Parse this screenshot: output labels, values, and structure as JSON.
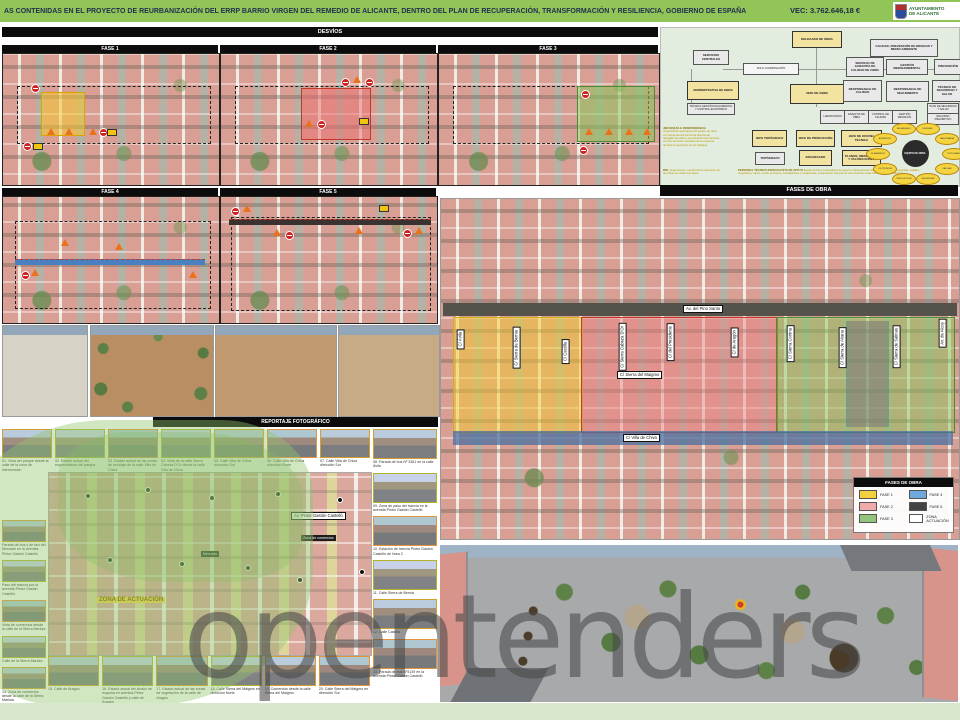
{
  "colors": {
    "header_green": "#92c558",
    "fase1": "#f4d03f",
    "fase2": "#f1a9a9",
    "fase3": "#93c47d",
    "fase4": "#6fa8dc",
    "fase5": "#434343",
    "zona": "#ffffff"
  },
  "header": {
    "title": "AS CONTENIDAS EN EL PROYECTO DE REURBANIZACIÓN DEL ERRP BARRIO VIRGEN DEL REMEDIO DE ALICANTE, DENTRO DEL PLAN DE RECUPERACIÓN, TRANSFORMACIÓN Y RESILIENCIA, GOBIERNO DE ESPAÑA",
    "vec": "VEC:  3.762.646,18 €",
    "logo_line1": "AYUNTAMIENTO",
    "logo_line2": "DE  ALICANTE"
  },
  "desvios": {
    "title": "DESVÍOS",
    "fase1": "FASE 1",
    "fase2": "FASE 2",
    "fase3": "FASE 3",
    "fase4": "FASE 4",
    "fase5": "FASE 5"
  },
  "fases_obra_bar": "FASES DE OBRA",
  "org": {
    "delegado": "DELEGADO DE OBRA",
    "calidad_prl": "CALIDAD, PREVENCIÓN DE RIESGOS Y MEDIO AMBIENTE",
    "servicios": "SERVICIOS CENTRALES",
    "coordinacion": "SOLO COORDINACIÓN",
    "garantia": "SERVICIO DE GARANTÍA DE CALIDAD DE OBRA",
    "medioambiental": "GESTIÓN MEDIOAMBIENTAL",
    "prevencion": "PREVENCIÓN",
    "administrativa": "ADMINISTRATIVA DE OBRA",
    "admin_sub": "TÉCNICO GESTIÓN DOCUMENTAL Y CONTROL ECONÓMICO",
    "jefe_obra": "JEFE DE OBRA",
    "resp_calidad": "RESPONSABLE DE CALIDAD",
    "resp_seguimiento": "RESPONSABLE DE SEGUIMIENTO",
    "tecnico_ss": "TÉCNICO DE SEGURIDAD Y SALUD",
    "sub1": "LABORATORIO",
    "sub2": "ENSAYOS DE OBRA",
    "sub3": "CONTROL DE CALIDAD",
    "sub4": "GESTIÓN RESIDUOS",
    "plan_ss": "PLAN DE SEGURIDAD Y SALUD",
    "recurso": "RECURSO PREVENTIVO",
    "jefe_topografo": "JEFE TOPÓGRAFO",
    "jefe_produccion": "JEFE DE PRODUCCIÓN",
    "jefe_oficina": "JEFE DE OFICINA TÉCNICA",
    "topografo": "TOPÓGRAFO",
    "encargado": "ENCARGADO",
    "planos": "PLANOS, MEDICIONES Y VALORACIONES",
    "jerarquia_heading": "JERARQUÍA E INDEPENDENCIA",
    "jerarquia_text": "Organización jerárquica del equipo de obra con dependencia funcional directa del delegado de obra y coordinación permanente con los servicios centrales de la empresa durante la ejecución de los trabajos.",
    "rol_heading": "ROL",
    "rol_text": "Seguimiento y control de la ejecución de las obras en todas sus fases.",
    "apoyo_heading": "PERSONAL TÉCNICO ESPECIALISTA DE APOYO",
    "apoyo_text": "Equipo técnico especialista de apoyo a obra para las distintas disciplinas: topografía, calidad, seguridad y salud, medio ambiente, instalaciones y maquinaria, a disposición del jefe de obra durante todas las fases de los trabajos.",
    "circle_center": "EQUIPO DE OBRA",
    "circle_items": [
      "TOPOGRAFÍA",
      "CALIDAD",
      "SEGURIDAD",
      "PRODUCCIÓN",
      "OF. TÉCNICA",
      "M. AMBIENTE",
      "ADMINISTR.",
      "ENCARGADO",
      "INSTALAC.",
      "MAQUINARIA"
    ]
  },
  "big_map": {
    "streets": [
      "Av. del Pino Santo",
      "C/ Ávila",
      "C/ Sierra de Bernia",
      "C/ Castilla",
      "C/ Sierra Cabeza D'Or",
      "C/ del Presidente",
      "C/ Sierra del Maigmo",
      "C/ de Aragón",
      "C/ Sierra Cortina",
      "C/ Sierra de Aitana",
      "C/ Sierra de Salinas",
      "C/ Villa de Chiva",
      "Av. de Alcoy"
    ],
    "legend": {
      "title": "FASES DE OBRA",
      "items": [
        {
          "label": "FASE 1",
          "color": "#f4d03f"
        },
        {
          "label": "FASE 2",
          "color": "#f1a9a9"
        },
        {
          "label": "FASE 3",
          "color": "#93c47d"
        },
        {
          "label": "FASE 4",
          "color": "#6fa8dc"
        },
        {
          "label": "FASE 5",
          "color": "#434343"
        },
        {
          "label": "ZONA  ACTUACIÓN",
          "color": "#ffffff"
        }
      ]
    }
  },
  "report": {
    "title": "REPORTAJE FOTOGRÁFICO",
    "top_row": [
      "01. Vista del parque desde la calle de la zona de intervención",
      "02. Estado actual del esparcimiento del parque",
      "03. Estado actual de las zonas de reciclaje de la calle Villa de Chiva",
      "04. Vista de la calle Sierra Cabeza D'Or desde la calle Villa de Chiva",
      "05. Calle Villa de Chiva dirección Sur",
      "06. Calle Villa de Chiva dirección Norte",
      "07. Calle Villa de Chiva dirección Sur"
    ],
    "right_col": [
      "08. Parada de bus Nº 3361 en la calle Ávila",
      "09. Zona de paso del tranvía en la avenida Pintor Gastón Castelló",
      "10. Estación de tranvía Pintor Gastón Castelló de línea 2",
      "11. Calle Sierra de Bernia",
      "12. Calle Castilla",
      "13. Parada de bus Nº3139 en la avenida Pintor Gastón Castelló"
    ],
    "left_col": [
      "Parada de bus y de taxi del Mercado en la avenida Pintor Gastón Castelló",
      "Paso del tranvía por la avenida Pintor Gastón Castelló",
      "Vista de comercios desde la calle de la Sierra Mariola",
      "Calle de la Sierra Mariola",
      "14. Zona de comercios desde la calle de la Sierra Mariola"
    ],
    "bottom_row": [
      "15. Calle de Aragón",
      "16. Estado actual del kiosko de esquina en avenida Pintor Gastón Castelló y calle de Aragón",
      "17. Estado actual de las zonas de vegetación de la calle de Aragón",
      "18. Calle Sierra del Maigmo en dirección Norte",
      "19. Comercios desde la calle Sierra del Maigmo",
      "20. Calle Sierra del Maigmo en dirección Sur"
    ]
  },
  "plan": {
    "zona_label": "ZONA DE ACTUACIÓN",
    "avenue": "Av. Pintor Gastón Castelló",
    "tag_mercado": "Mercado",
    "tag_comercios": "Zona de comercios"
  },
  "watermark": "opentenders"
}
